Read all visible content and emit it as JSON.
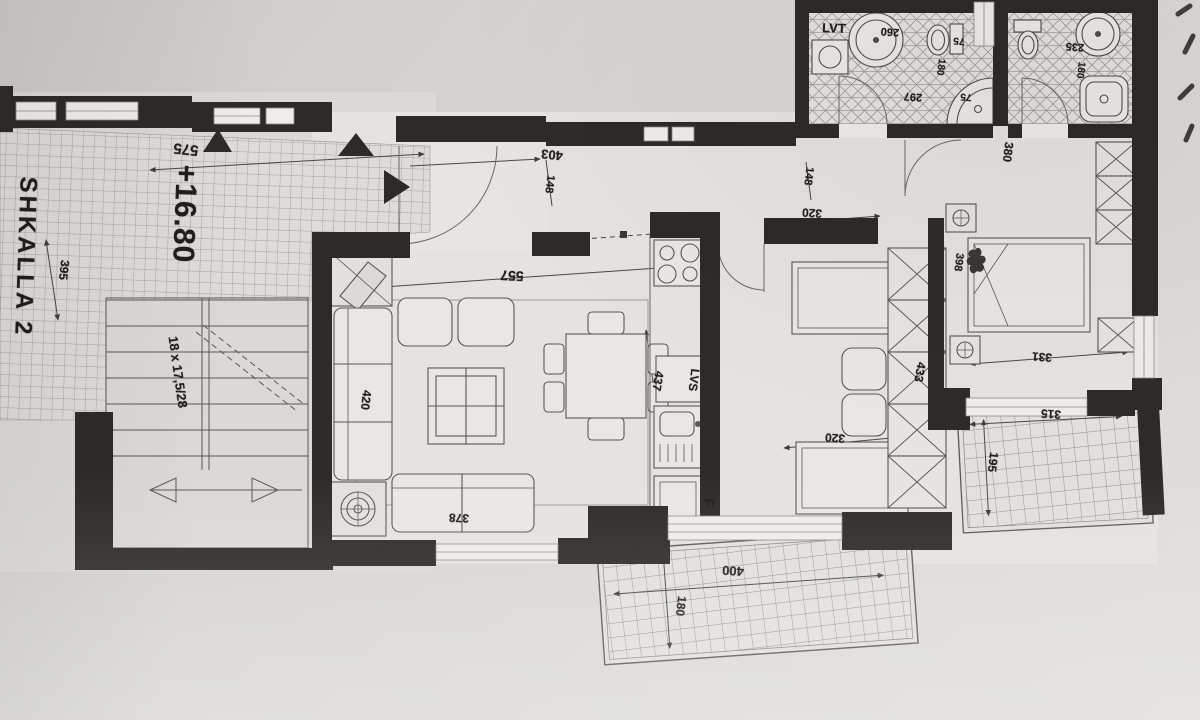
{
  "document": {
    "type": "scanned architectural floor plan",
    "colors": {
      "paper": "#d6d4d1",
      "wall_ink": "#2d2b28",
      "line_ink": "#55524e",
      "dim_ink": "#454340"
    }
  },
  "rooms": {
    "stairwell": {
      "label": "SHKALLA 2",
      "elevation": "+16.80",
      "stair_note": "18 x 17,5/28",
      "dims": [
        "575",
        "395"
      ]
    },
    "entry_hall": {
      "dims": [
        "403",
        "148"
      ]
    },
    "living_room": {
      "dims": [
        "557",
        "420",
        "378"
      ]
    },
    "kitchen": {
      "dims": [
        "437"
      ],
      "appliance_labels": [
        "LVS",
        "F"
      ]
    },
    "bedroom_middle": {
      "dims": [
        "148",
        "320",
        "320",
        "433"
      ]
    },
    "bedroom_right": {
      "dims": [
        "380",
        "398",
        "331"
      ]
    },
    "bathroom_large": {
      "label": "LVT",
      "dims": [
        "260",
        "75",
        "180",
        "297",
        "75"
      ]
    },
    "bathroom_small": {
      "dims": [
        "235",
        "180"
      ]
    },
    "balcony_bottom": {
      "dims": [
        "400",
        "180"
      ]
    },
    "terrace_right": {
      "dims": [
        "315",
        "195"
      ]
    }
  },
  "labels": [
    {
      "name": "stairwell-name-label",
      "text": "SHKALLA 2",
      "x": 25,
      "y": 257,
      "rot": 92,
      "size": 24,
      "ls": 3
    },
    {
      "name": "elevation-label",
      "text": "+16.80",
      "x": 184,
      "y": 214,
      "rot": 92,
      "size": 30,
      "ls": 1
    },
    {
      "name": "dim-575",
      "text": "575",
      "x": 186,
      "y": 149,
      "rot": 186,
      "size": 15
    },
    {
      "name": "dim-395",
      "text": "395",
      "x": 64,
      "y": 270,
      "rot": 96,
      "size": 12
    },
    {
      "name": "stair-note-label",
      "text": "18 x 17,5/28",
      "x": 178,
      "y": 372,
      "rot": 82,
      "size": 13
    },
    {
      "name": "dim-403",
      "text": "403",
      "x": 552,
      "y": 155,
      "rot": 186,
      "size": 13
    },
    {
      "name": "dim-148-hall",
      "text": "148",
      "x": 549,
      "y": 184,
      "rot": 97,
      "size": 11
    },
    {
      "name": "dim-557",
      "text": "557",
      "x": 512,
      "y": 276,
      "rot": 183,
      "size": 14
    },
    {
      "name": "dim-420",
      "text": "420",
      "x": 366,
      "y": 400,
      "rot": 96,
      "size": 12
    },
    {
      "name": "dim-378",
      "text": "378",
      "x": 459,
      "y": 518,
      "rot": 183,
      "size": 12
    },
    {
      "name": "dim-437",
      "text": "437",
      "x": 658,
      "y": 381,
      "rot": 100,
      "size": 12
    },
    {
      "name": "dishwasher-label",
      "text": "LVS",
      "x": 694,
      "y": 380,
      "rot": 97,
      "size": 12
    },
    {
      "name": "fridge-label",
      "text": "F",
      "x": 708,
      "y": 503,
      "rot": 94,
      "size": 15
    },
    {
      "name": "dim-148-bedroom",
      "text": "148",
      "x": 808,
      "y": 176,
      "rot": 97,
      "size": 11
    },
    {
      "name": "dim-320-mid-top",
      "text": "320",
      "x": 812,
      "y": 213,
      "rot": 184,
      "size": 12
    },
    {
      "name": "dim-320-mid-bottom",
      "text": "320",
      "x": 835,
      "y": 438,
      "rot": 184,
      "size": 12
    },
    {
      "name": "dim-433",
      "text": "433",
      "x": 920,
      "y": 372,
      "rot": 100,
      "size": 12
    },
    {
      "name": "dim-380",
      "text": "380",
      "x": 1008,
      "y": 152,
      "rot": 97,
      "size": 12
    },
    {
      "name": "dim-398",
      "text": "398",
      "x": 958,
      "y": 262,
      "rot": 97,
      "size": 11
    },
    {
      "name": "dim-331",
      "text": "331",
      "x": 1042,
      "y": 357,
      "rot": 184,
      "size": 12
    },
    {
      "name": "dim-315",
      "text": "315",
      "x": 1051,
      "y": 414,
      "rot": 184,
      "size": 12
    },
    {
      "name": "dim-195",
      "text": "195",
      "x": 993,
      "y": 462,
      "rot": 97,
      "size": 12
    },
    {
      "name": "dim-400",
      "text": "400",
      "x": 733,
      "y": 571,
      "rot": 184,
      "size": 13
    },
    {
      "name": "dim-180-balcony",
      "text": "180",
      "x": 681,
      "y": 606,
      "rot": 97,
      "size": 12
    },
    {
      "name": "washing-machine-label",
      "text": "LVT",
      "x": 834,
      "y": 28,
      "rot": 2,
      "size": 13
    },
    {
      "name": "dim-260",
      "text": "260",
      "x": 890,
      "y": 31,
      "rot": 184,
      "size": 11
    },
    {
      "name": "dim-75-toilet",
      "text": "75",
      "x": 959,
      "y": 40,
      "rot": 184,
      "size": 10
    },
    {
      "name": "dim-180-bath1",
      "text": "180",
      "x": 940,
      "y": 67,
      "rot": 97,
      "size": 10
    },
    {
      "name": "dim-297",
      "text": "297",
      "x": 913,
      "y": 96,
      "rot": 184,
      "size": 11
    },
    {
      "name": "dim-75-shower",
      "text": "75",
      "x": 966,
      "y": 96,
      "rot": 184,
      "size": 10
    },
    {
      "name": "dim-235",
      "text": "235",
      "x": 1075,
      "y": 46,
      "rot": 184,
      "size": 11
    },
    {
      "name": "dim-180-bath2",
      "text": "180",
      "x": 1080,
      "y": 70,
      "rot": 97,
      "size": 10
    }
  ]
}
